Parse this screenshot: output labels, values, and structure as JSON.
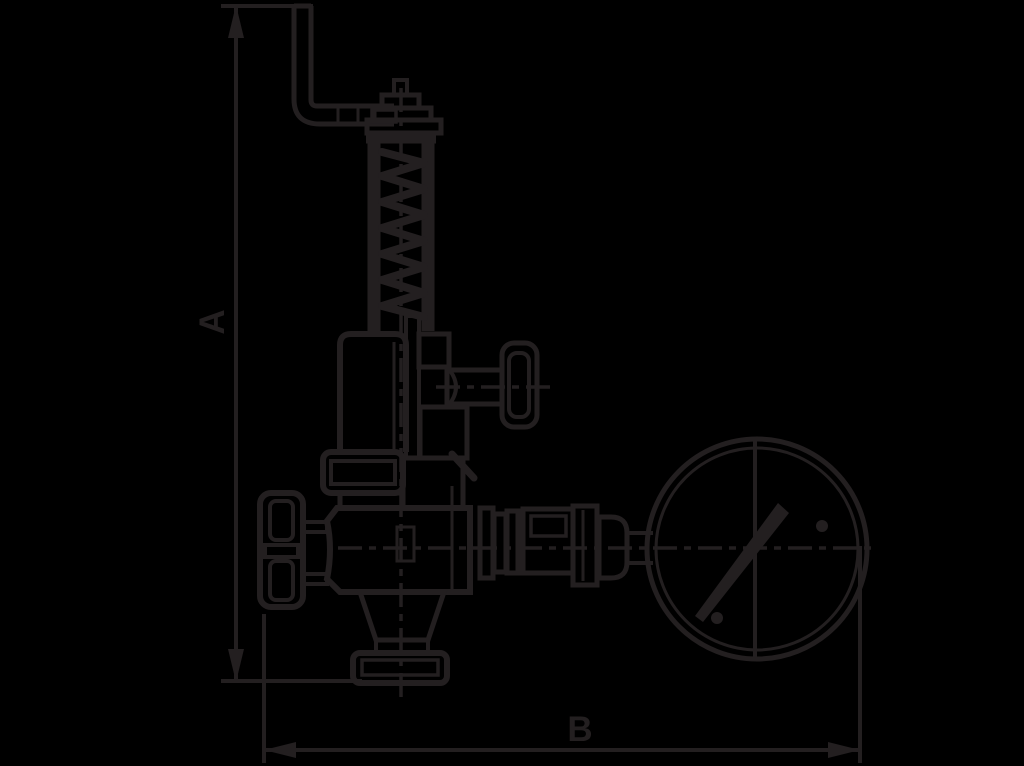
{
  "diagram": {
    "type": "technical dimension drawing (black line art)",
    "subject": "spring-loaded safety relief valve with lifting lever, test knob, handwheel and pressure gauge",
    "dimensions": [
      {
        "label": "A",
        "orientation": "vertical"
      },
      {
        "label": "B",
        "orientation": "horizontal"
      }
    ],
    "colors": {
      "background": "#000000",
      "ink": "#231f20"
    }
  }
}
